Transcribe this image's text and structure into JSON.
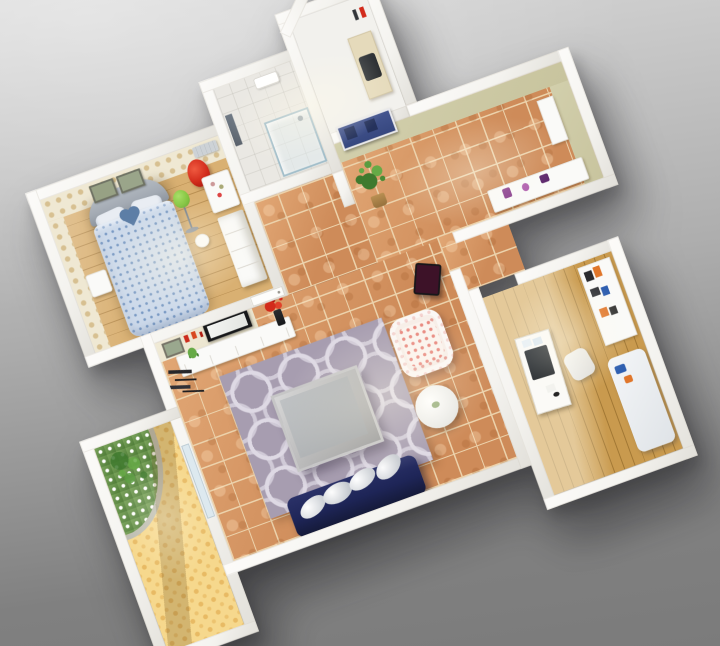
{
  "scene": {
    "title": "3D apartment floor-plan render",
    "view": "top-down dollhouse perspective, plan rotated about 20 degrees, gray studio backdrop",
    "rooms": [
      {
        "name": "bedroom",
        "floor": "light oak plank",
        "walls": "cream polka-dot wallpaper",
        "furniture": [
          "double bed with blue dotted duvet",
          "gray curved headboard",
          "two white pillows",
          "blue heart-shaped pillow",
          "two framed wall pictures",
          "white nightstand",
          "green floor lamp",
          "red egg chair",
          "white vanity table",
          "white wardrobe",
          "white stool",
          "air conditioner"
        ]
      },
      {
        "name": "bathroom",
        "floor": "white tile",
        "furniture": [
          "wall mirror",
          "glass shower enclosure",
          "washbasin"
        ]
      },
      {
        "name": "utility-nook",
        "floor": "white",
        "walls": "white with chamfered corner",
        "furniture": [
          "counter with dark sink",
          "towel rail with red towel"
        ]
      },
      {
        "name": "entry-hall",
        "floor": "terracotta tile",
        "walls": "sage green wallpaper",
        "furniture": [
          "navy entry door",
          "potted plant",
          "white sideboard with purple ornaments",
          "tall white cabinet"
        ]
      },
      {
        "name": "living-room",
        "floor": "terracotta tile",
        "walls": "cream wallpaper",
        "furniture": [
          "wall-mounted TV",
          "wall shelves with red ornaments",
          "framed picture",
          "white TV cabinet with small plant",
          "vase with red flowers",
          "purple ring-pattern rug",
          "silver square coffee table",
          "navy sofa with four white pillows",
          "floral armchair",
          "white round side table",
          "dark dining chair",
          "black floor clutter",
          "white interior door",
          "window to balcony"
        ]
      },
      {
        "name": "balcony",
        "floor": "yellow dotted",
        "furniture": [
          "corner flower bed with white blossoms and stone edge",
          "white railing walls"
        ]
      },
      {
        "name": "study",
        "floor": "oak plank",
        "furniture": [
          "white desk with monitor",
          "desk chair",
          "wall shelf unit with books",
          "white daybed with blue and orange cushions"
        ]
      }
    ]
  },
  "colors": {
    "backdrop_top": "#d8d8d8",
    "backdrop_mid": "#aeaeae",
    "backdrop_bottom": "#808080",
    "wall": "#f4f3ef",
    "wall_shade": "#e2e0da",
    "bedroom_paper": "#efe8d3",
    "bedroom_dot": "#d7c091",
    "bedroom_floor": "#d9b072",
    "bedroom_floor_line": "#b98f52",
    "bath_floor": "#eae8e3",
    "nook_floor": "#f2f1ed",
    "tile": "#ce8b59",
    "tile_light": "#e2a876",
    "tile_grout": "#ecd2ab",
    "entry_paper": "#c8c49e",
    "living_paper": "#e9e3cc",
    "rug": "#a79db0",
    "rug_ring": "#ded9e4",
    "sofa": "#1e2557",
    "coffee_outer": "#c6c6c6",
    "coffee_inner": "#a2a5a7",
    "armchair": "#f7eee8",
    "floral": "#e59a92",
    "balcony_floor": "#f6d88d",
    "balcony_dot": "#e8ba64",
    "study_floor": "#c99a4e",
    "study_line": "#a27834",
    "door_navy": "#36477f",
    "accent_red": "#d22b1b",
    "lamp_green": "#82c43f",
    "plant_dark": "#3f7a2e",
    "plant_light": "#66aa46",
    "purple": "#8a3f8f",
    "orange": "#e0762a",
    "blue": "#2f5fb0",
    "duvet": "#ccd9ea",
    "duvet_dot": "#7a9ac4",
    "headboard": "#a3aab3",
    "heart": "#5d7ea6",
    "window": "#dde9ef",
    "mirror": "#59616b",
    "monitor": "#1e2226",
    "counter": "#e5dabb",
    "white_f": "#fafaf8"
  }
}
